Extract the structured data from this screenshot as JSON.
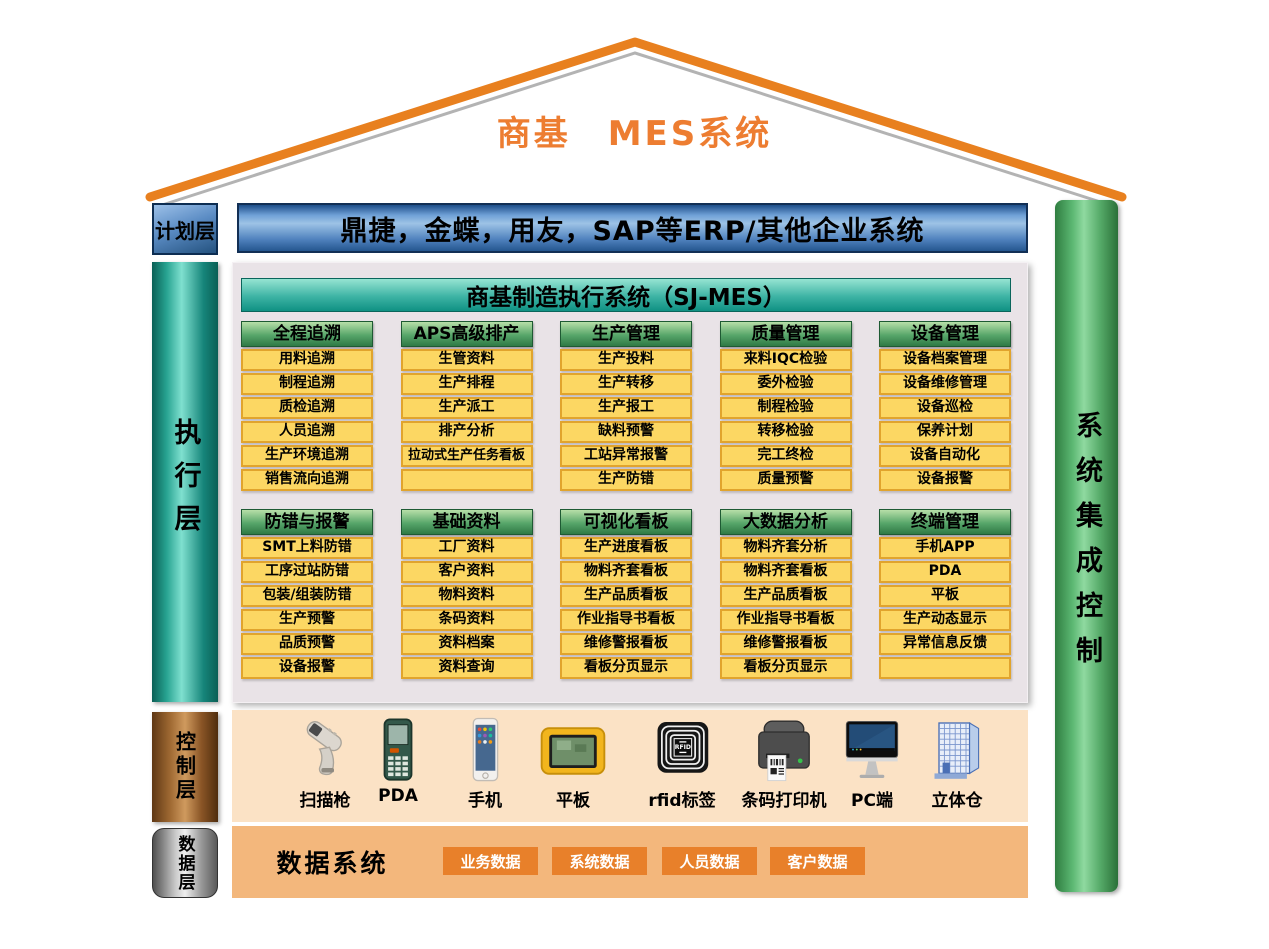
{
  "title": "商基　MES系统",
  "layers": {
    "plan": {
      "label": "计划层"
    },
    "execution": {
      "label": "执行层"
    },
    "control": {
      "label": "控制层"
    },
    "data": {
      "label": "数据层"
    }
  },
  "right_bar": {
    "label": "系统集成控制"
  },
  "erp_bar": {
    "text": "鼎捷，金蝶，用友，SAP等ERP/其他企业系统"
  },
  "mes": {
    "header": "商基制造执行系统（SJ-MES）",
    "row1": [
      {
        "header": "全程追溯",
        "items": [
          "用料追溯",
          "制程追溯",
          "质检追溯",
          "人员追溯",
          "生产环境追溯",
          "销售流向追溯"
        ]
      },
      {
        "header": "APS高级排产",
        "items": [
          "生管资料",
          "生产排程",
          "生产派工",
          "排产分析",
          "拉动式生产任务看板",
          ""
        ]
      },
      {
        "header": "生产管理",
        "items": [
          "生产投料",
          "生产转移",
          "生产报工",
          "缺料预警",
          "工站异常报警",
          "生产防错"
        ]
      },
      {
        "header": "质量管理",
        "items": [
          "来料IQC检验",
          "委外检验",
          "制程检验",
          "转移检验",
          "完工终检",
          "质量预警"
        ]
      },
      {
        "header": "设备管理",
        "items": [
          "设备档案管理",
          "设备维修管理",
          "设备巡检",
          "保养计划",
          "设备自动化",
          "设备报警"
        ]
      }
    ],
    "row2": [
      {
        "header": "防错与报警",
        "items": [
          "SMT上料防错",
          "工序过站防错",
          "包装/组装防错",
          "生产预警",
          "品质预警",
          "设备报警"
        ]
      },
      {
        "header": "基础资料",
        "items": [
          "工厂资料",
          "客户资料",
          "物料资料",
          "条码资料",
          "资料档案",
          "资料查询"
        ]
      },
      {
        "header": "可视化看板",
        "items": [
          "生产进度看板",
          "物料齐套看板",
          "生产品质看板",
          "作业指导书看板",
          "维修警报看板",
          "看板分页显示"
        ]
      },
      {
        "header": "大数据分析",
        "items": [
          "物料齐套分析",
          "物料齐套看板",
          "生产品质看板",
          "作业指导书看板",
          "维修警报看板",
          "看板分页显示"
        ]
      },
      {
        "header": "终端管理",
        "items": [
          "手机APP",
          "PDA",
          "平板",
          "生产动态显示",
          "异常信息反馈",
          ""
        ]
      }
    ]
  },
  "devices": [
    {
      "icon": "scanner-icon",
      "label": "扫描枪"
    },
    {
      "icon": "pda-icon",
      "label": "PDA"
    },
    {
      "icon": "phone-icon",
      "label": "手机"
    },
    {
      "icon": "tablet-icon",
      "label": "平板"
    },
    {
      "icon": "rfid-tag-icon",
      "label": "rfid标签"
    },
    {
      "icon": "barcode-printer-icon",
      "label": "条码打印机"
    },
    {
      "icon": "pc-icon",
      "label": "PC端"
    },
    {
      "icon": "warehouse-icon",
      "label": "立体仓"
    }
  ],
  "data_layer": {
    "system_label": "数据系统",
    "boxes": [
      "业务数据",
      "系统数据",
      "人员数据",
      "客户数据"
    ]
  },
  "colors": {
    "roof_orange": "#E8801F",
    "title_orange": "#ED7D31",
    "erp_blue": "#4F81BD",
    "teal_bar": "#27A391",
    "green_header": "#57A66A",
    "right_bar_green": "#5CB873",
    "item_yellow": "#FCD763",
    "item_border": "#E1A42D",
    "panel_bg": "#E9E3E7",
    "control_bg": "#FBE2C5",
    "data_bg": "#F3B77C",
    "data_box_orange": "#E8802A"
  }
}
